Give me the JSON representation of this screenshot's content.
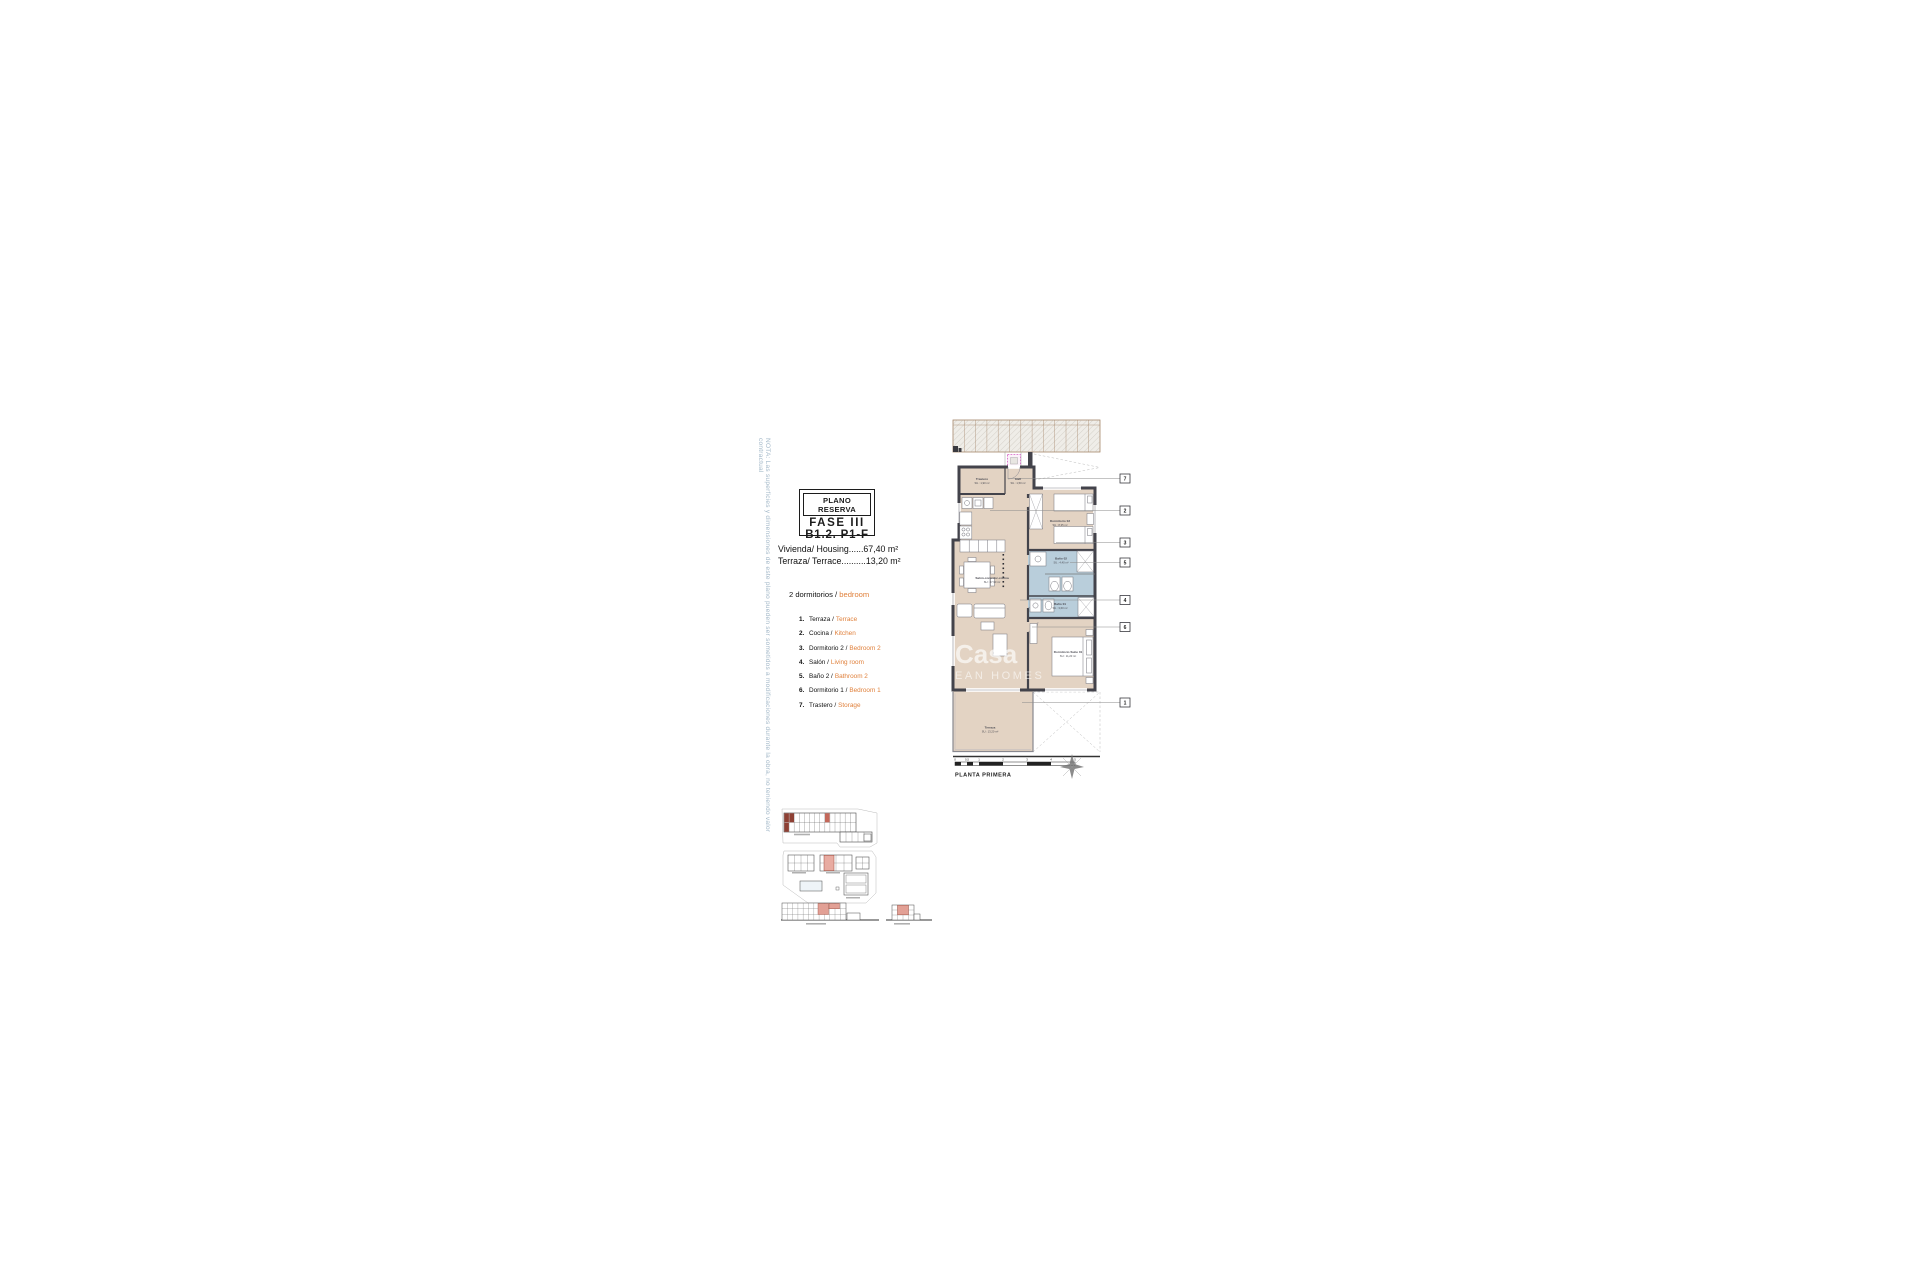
{
  "note": "NOTA: Las superficies y dimensiones de este plano pueden ser sometidos a modificaciones durante la obra, no teniendo valor contractual",
  "title_block": {
    "reserva": "PLANO RESERVA",
    "fase": "FASE III",
    "ref": "B1.2. P1-F"
  },
  "areas": {
    "housing": "Vivienda/ Housing......67,40 m²",
    "terrace": "Terraza/ Terrace..........13,20 m²"
  },
  "bedrooms": {
    "count_es": "2 dormitorios /",
    "en": "bedroom"
  },
  "legend": [
    {
      "num": "1.",
      "es": "Terraza /",
      "en": "Terrace"
    },
    {
      "num": "2.",
      "es": "Cocina /",
      "en": "Kitchen"
    },
    {
      "num": "3.",
      "es": "Dormitorio 2 /",
      "en": "Bedroom 2"
    },
    {
      "num": "4.",
      "es": "Salón /",
      "en": "Living room"
    },
    {
      "num": "5.",
      "es": "Baño 2 /",
      "en": "Bathroom 2"
    },
    {
      "num": "6.",
      "es": "Dormitorio 1 /",
      "en": "Bedroom 1"
    },
    {
      "num": "7.",
      "es": "Trastero /",
      "en": "Storage"
    }
  ],
  "plan": {
    "floor_label": "PLANTA PRIMERA",
    "scale_ticks": [
      "0",
      "0,5",
      "1",
      "2",
      "3",
      "4",
      "5"
    ],
    "callouts": [
      "7",
      "2",
      "3",
      "5",
      "4",
      "6",
      "1"
    ],
    "rooms": {
      "trastero": {
        "name": "Trastero",
        "area": "SU.: 1,90 m²"
      },
      "hall": {
        "name": "Hall",
        "area": "SU.: 1,50 m²"
      },
      "dormitorio2": {
        "name": "Dormitorio 02",
        "area": "SU.: 8,35 m²"
      },
      "bano2": {
        "name": "Baño 02",
        "area": "SU.: 4,40 m²"
      },
      "salon": {
        "name": "Salón-comedor-cocina",
        "area": "SU.: 27,90 m²"
      },
      "bano1": {
        "name": "Baño 01",
        "area": "SU.: 3,60 m²"
      },
      "suite": {
        "name": "Dormitorio Suite 01",
        "area": "SU.: 11,20 m²"
      },
      "terraza": {
        "name": "Terraza",
        "area": "SU.: 13,20 m²"
      }
    }
  },
  "watermark": {
    "line1": "Casa",
    "line2": "EAN HOMES"
  },
  "colors": {
    "accent_orange": "#e0813c",
    "wall": "#43434b",
    "floor_tan": "#e3d3c3",
    "bath_blue": "#b9cedb",
    "magenta": "#d35cc3",
    "note_blue": "#a4b9c9",
    "highlight_red": "#9c4a3c"
  }
}
